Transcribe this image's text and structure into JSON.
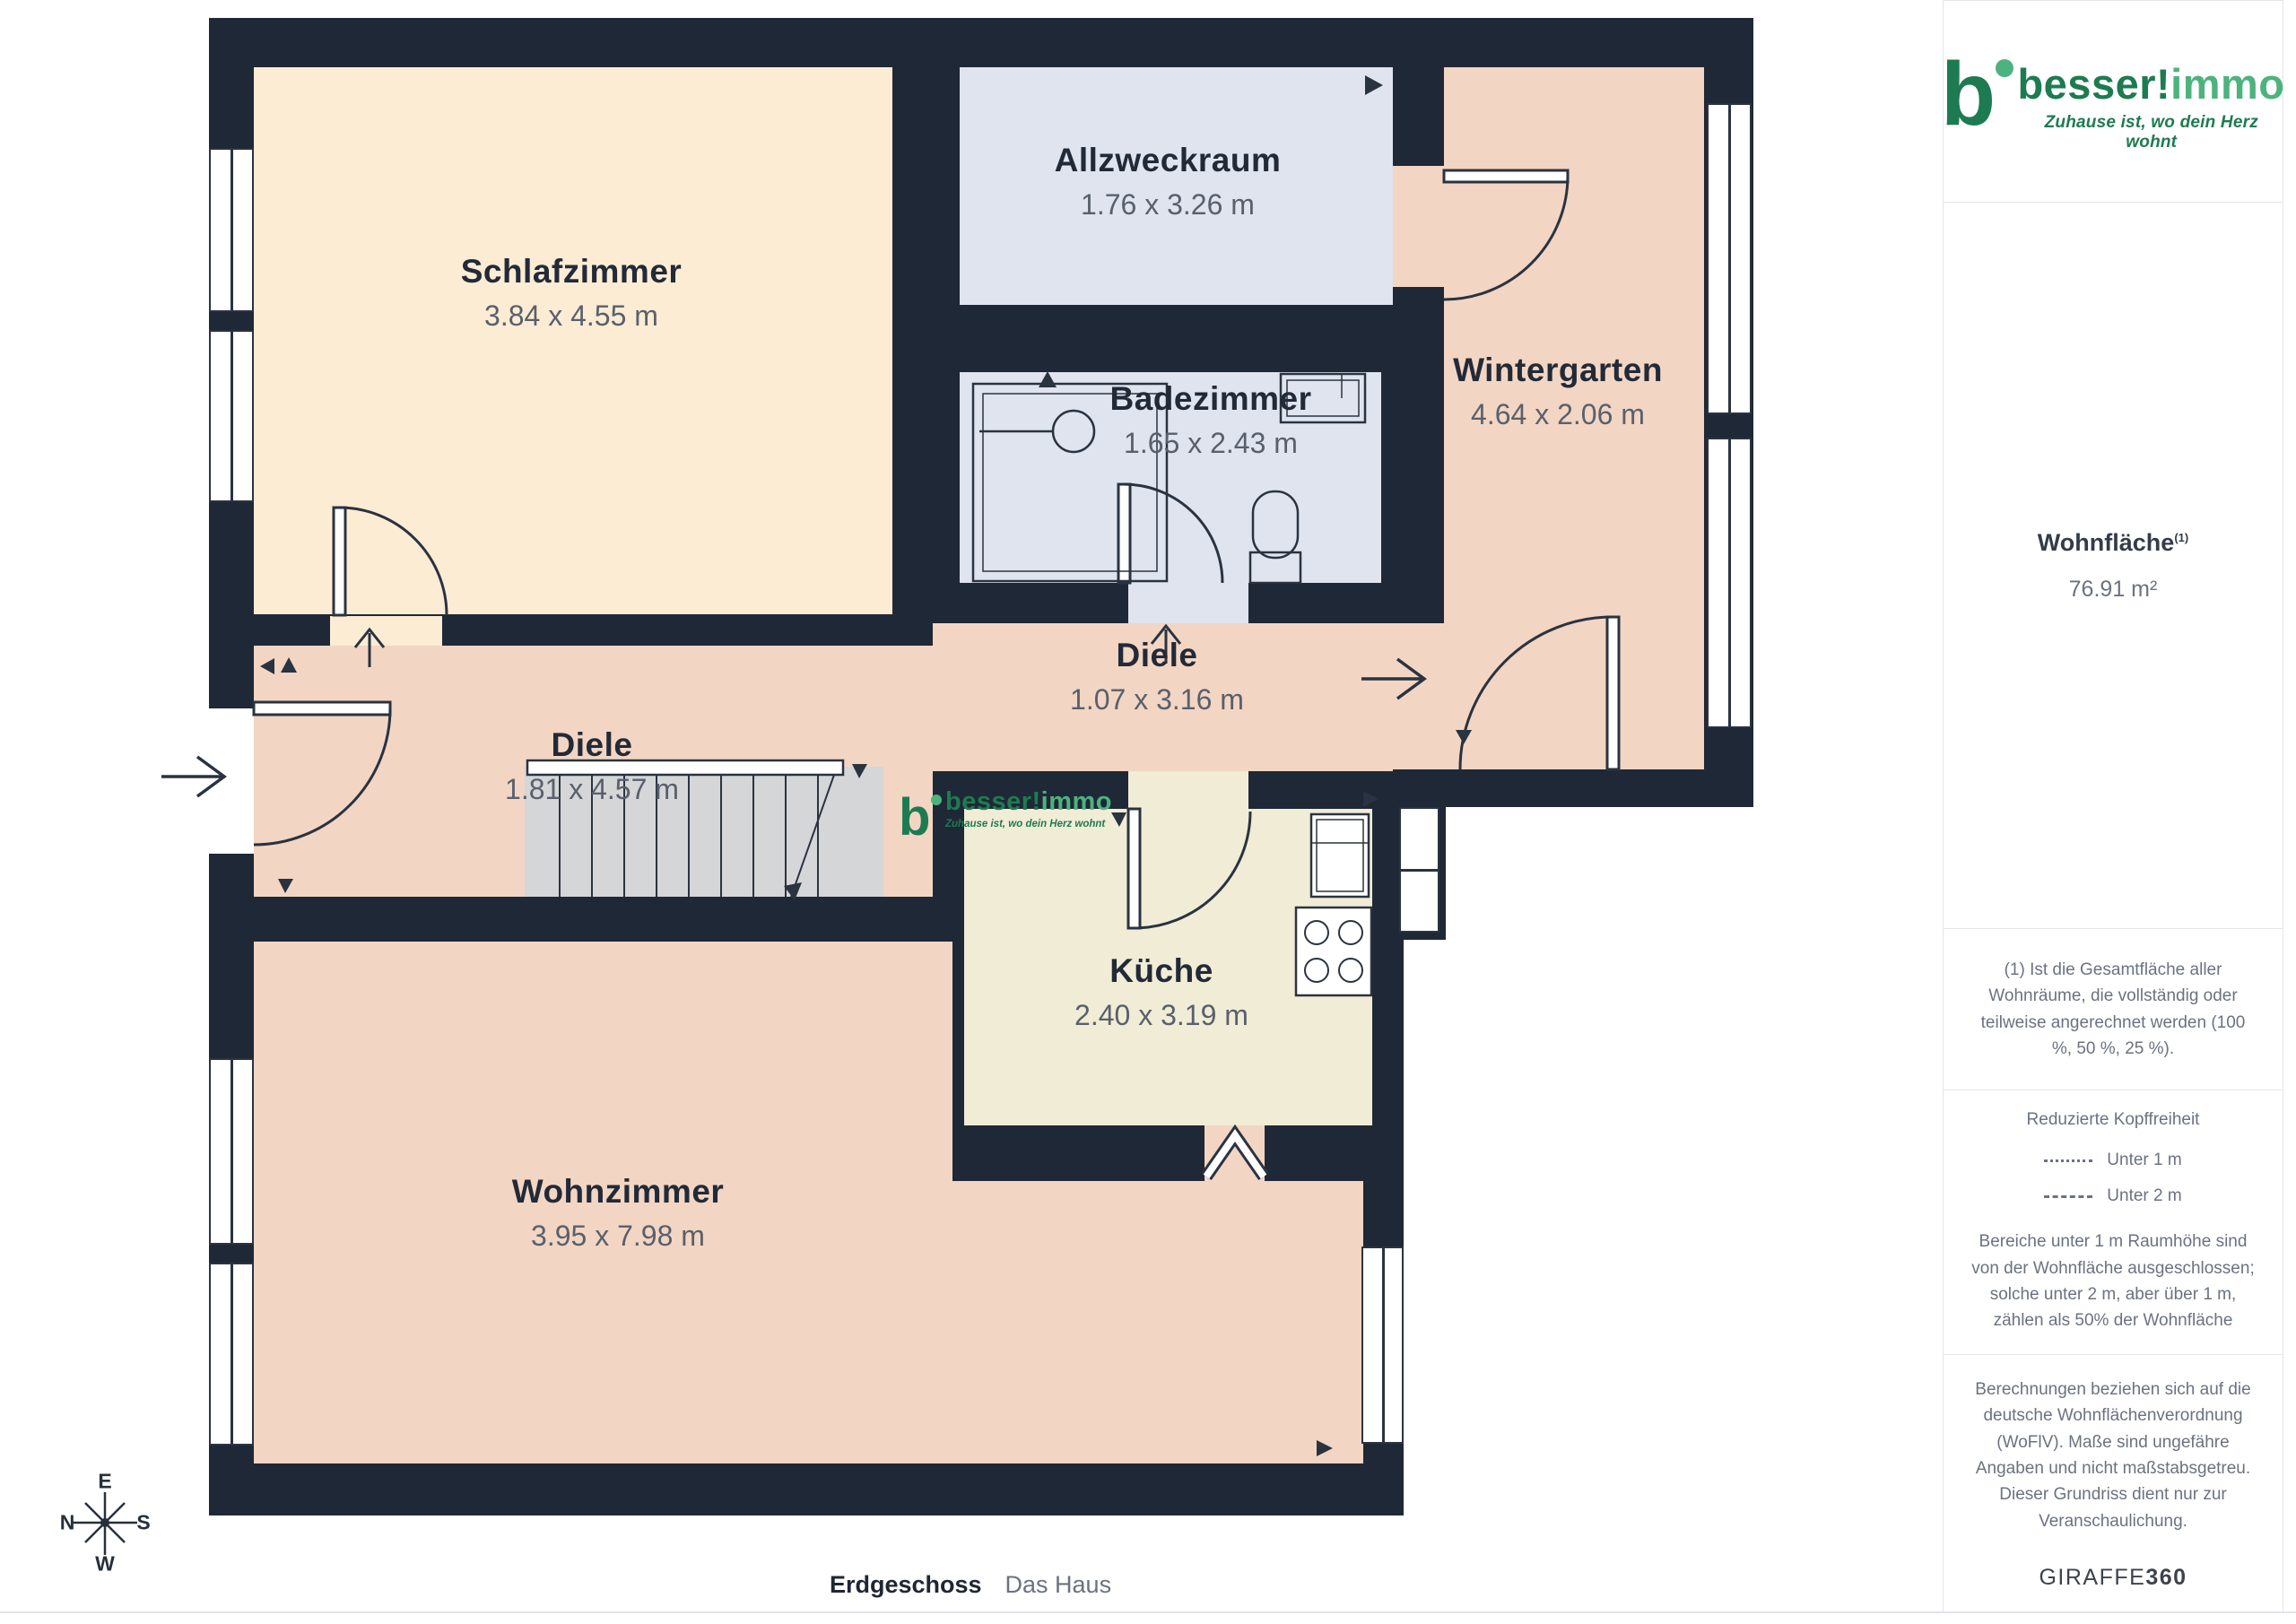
{
  "plan": {
    "rooms": [
      {
        "name": "Schlafzimmer",
        "dims": "3.84 x 4.55 m"
      },
      {
        "name": "Allzweckraum",
        "dims": "1.76 x 3.26 m"
      },
      {
        "name": "Badezimmer",
        "dims": "1.65 x 2.43 m"
      },
      {
        "name": "Wintergarten",
        "dims": "4.64 x 2.06 m"
      },
      {
        "name": "Diele",
        "dims": "1.07 x 3.16 m"
      },
      {
        "name": "Diele",
        "dims": "1.81 x 4.57 m"
      },
      {
        "name": "Küche",
        "dims": "2.40 x 3.19 m"
      },
      {
        "name": "Wohnzimmer",
        "dims": "3.95 x 7.98 m"
      }
    ],
    "compass": {
      "top": "E",
      "right": "S",
      "bottom": "W",
      "left": "N"
    },
    "watermark": {
      "brand_primary": "besser!",
      "brand_secondary": "immo",
      "icon_letter": "b",
      "tagline": "Zuhause ist, wo dein Herz wohnt"
    }
  },
  "sidebar": {
    "logo": {
      "brand_primary": "besser!",
      "brand_secondary": "immo",
      "icon_letter": "b",
      "tagline": "Zuhause ist, wo dein Herz wohnt"
    },
    "area": {
      "label": "Wohnfläche",
      "footnote_marker": "(1)",
      "value": "76.91 m²"
    },
    "footnote1": "(1) Ist die Gesamtfläche aller Wohnräume, die vollständig oder teilweise angerechnet werden (100 %, 50 %, 25 %).",
    "headroom": {
      "title": "Reduzierte Kopffreiheit",
      "legend": [
        {
          "style": "dotted",
          "label": "Unter 1 m"
        },
        {
          "style": "dashed",
          "label": "Unter 2 m"
        }
      ],
      "note": "Bereiche unter 1 m Raumhöhe sind von der Wohnfläche ausgeschlossen; solche unter 2 m, aber über 1 m, zählen als 50% der Wohnfläche"
    },
    "disclaimer": "Berechnungen beziehen sich auf die deutsche Wohnflächenverordnung (WoFlV). Maße sind ungefähre Angaben und nicht maßstabsgetreu. Dieser Grundriss dient nur zur Veranschaulichung.",
    "brand": {
      "name": "GIRAFFE",
      "suffix": "360"
    }
  },
  "caption": {
    "floor": "Erdgeschoss",
    "building": "Das Haus"
  },
  "colors": {
    "wall": "#1f2836",
    "floor_cream": "#fcecd4",
    "floor_pink": "#f2d5c3",
    "floor_blue": "#dfe4ef",
    "floor_beige": "#f1ecd6",
    "stairs": "#d5d6d8",
    "logo_green_dark": "#1e7b51",
    "logo_green_light": "#4db37e"
  }
}
